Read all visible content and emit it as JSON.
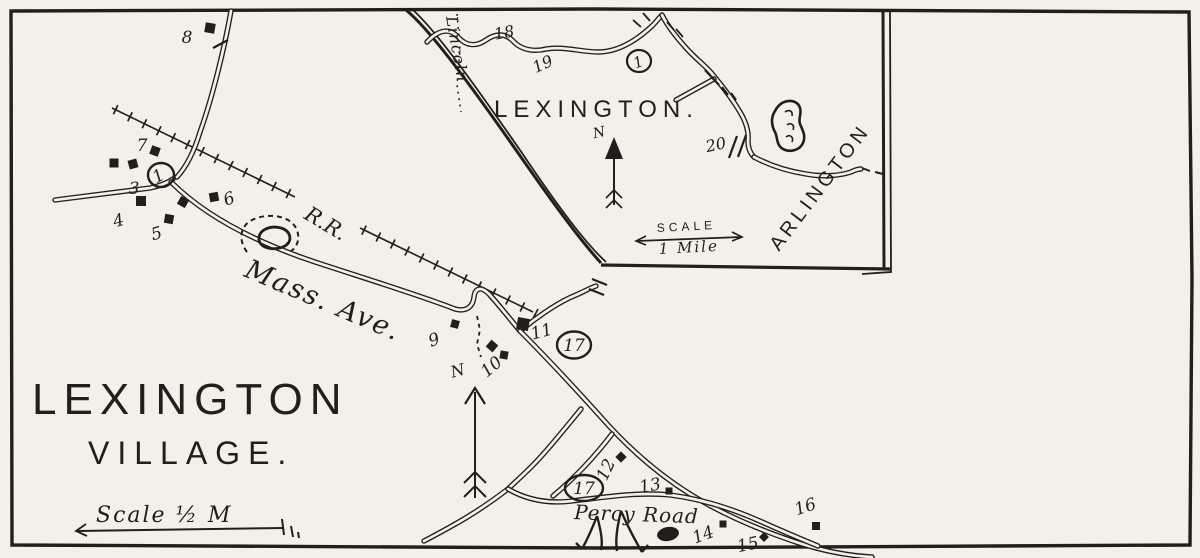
{
  "colors": {
    "ink": "#211f1c",
    "paper": "#f2f0e9"
  },
  "main_map": {
    "title_line1": "LEXINGTON",
    "title_line2": "VILLAGE.",
    "scale_label": "Scale ½ M",
    "north_label": "N",
    "roads": {
      "mass_ave": "Mass. Ave.",
      "railroad": "R.R.",
      "percy_road": "Percy Road"
    },
    "numbers": [
      "8",
      "7",
      "3",
      "4",
      "5",
      "6",
      "9",
      "10",
      "11",
      "12",
      "13",
      "14",
      "15",
      "16"
    ],
    "circled": [
      "1",
      "17",
      "17"
    ]
  },
  "inset_map": {
    "title": "LEXINGTON.",
    "region_left": "Lincoln",
    "region_right": "ARLINGTON",
    "scale_word": "SCALE",
    "scale_distance": "1 Mile",
    "north_label": "N",
    "numbers": [
      "18",
      "19",
      "20"
    ],
    "circled": [
      "1"
    ]
  }
}
